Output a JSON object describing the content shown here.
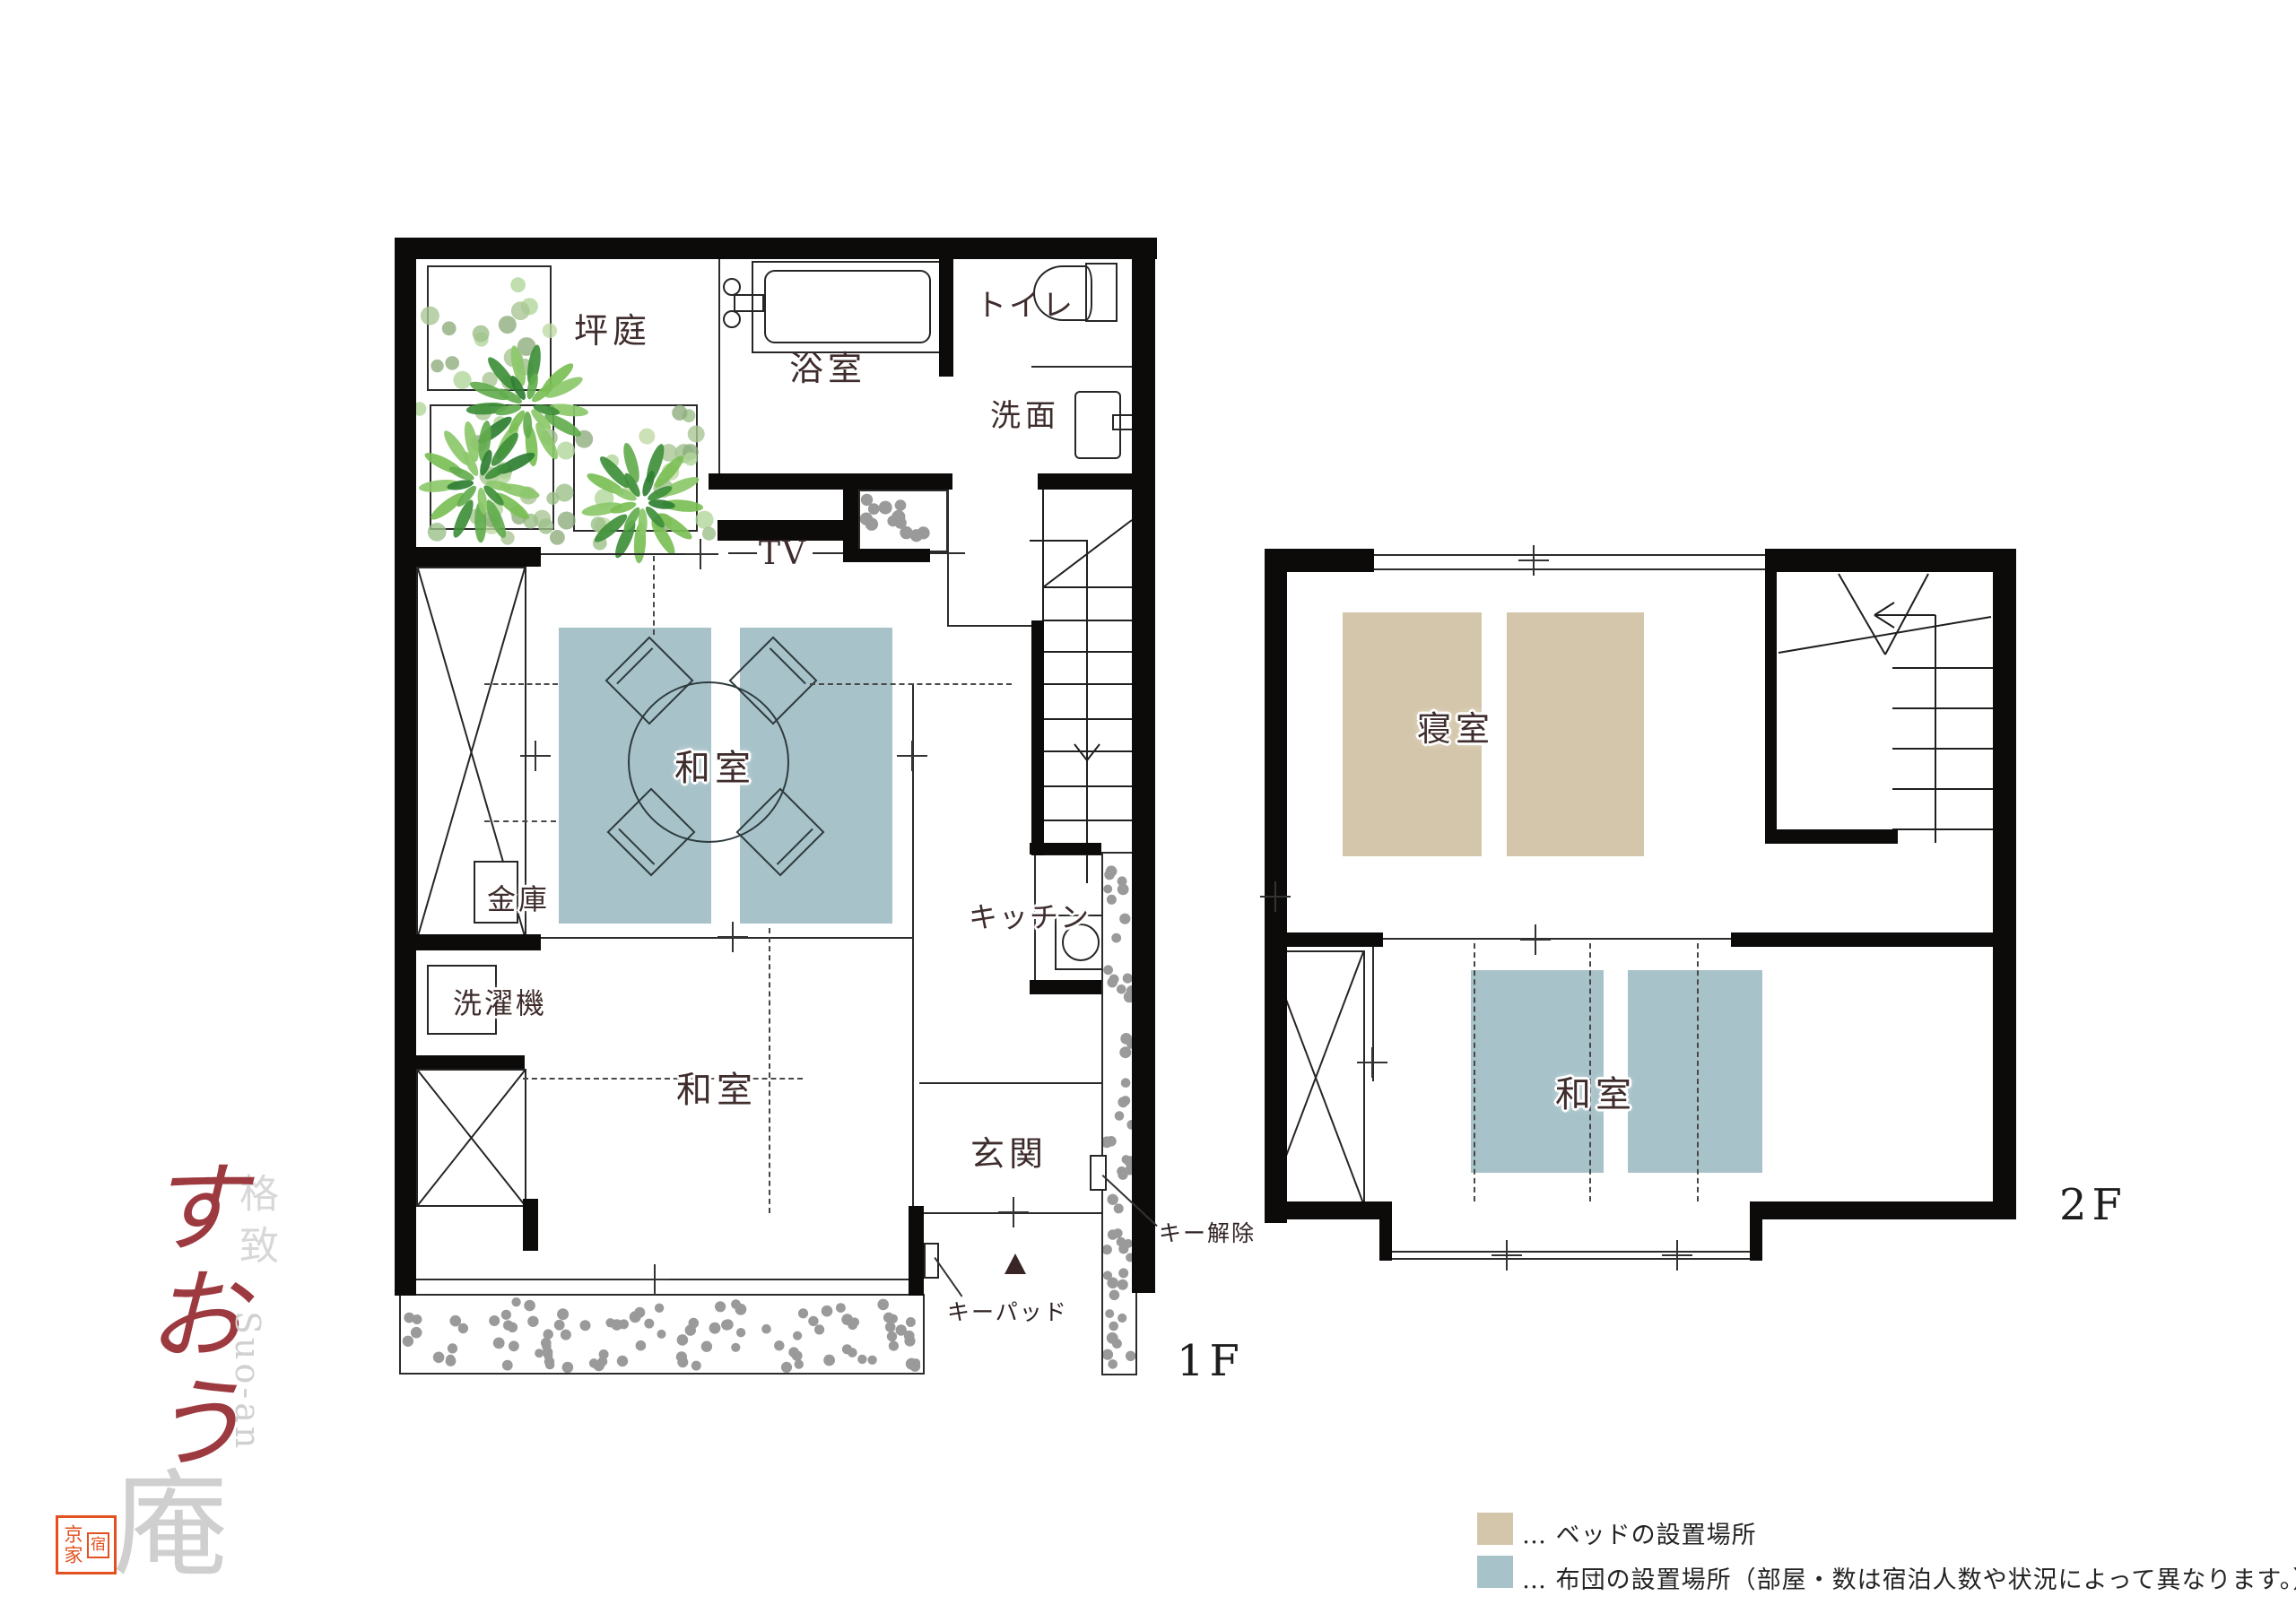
{
  "floor1": {
    "label": "1F",
    "rooms": {
      "garden": "坪庭",
      "bath": "浴室",
      "toilet": "トイレ",
      "washroom": "洗面",
      "tv": "TV",
      "washitsu_main": "和室",
      "safe": "金庫",
      "washing_machine": "洗濯機",
      "kitchen": "キッチン",
      "washitsu_front": "和室",
      "entrance": "玄関"
    },
    "annotations": {
      "keypad": "キーパッド",
      "key_release": "キー解除"
    }
  },
  "floor2": {
    "label": "2F",
    "rooms": {
      "bedroom": "寝室",
      "washitsu": "和室"
    }
  },
  "legend": {
    "items": [
      {
        "name": "bed",
        "color": "#d4c6aa",
        "label": "… ベッドの設置場所"
      },
      {
        "name": "futon",
        "color": "#a7c2c9",
        "label": "… 布団の設置場所（部屋・数は宿泊人数や状況によって異なります。）"
      }
    ]
  },
  "branding": {
    "tagline": "格致",
    "name_kana": "すおう",
    "name_romaji": "Suo-an",
    "name_an": "庵",
    "seal_left": "京家",
    "seal_right": "宿",
    "brand_red": "#9c3a40",
    "seal_red": "#e2511f"
  }
}
